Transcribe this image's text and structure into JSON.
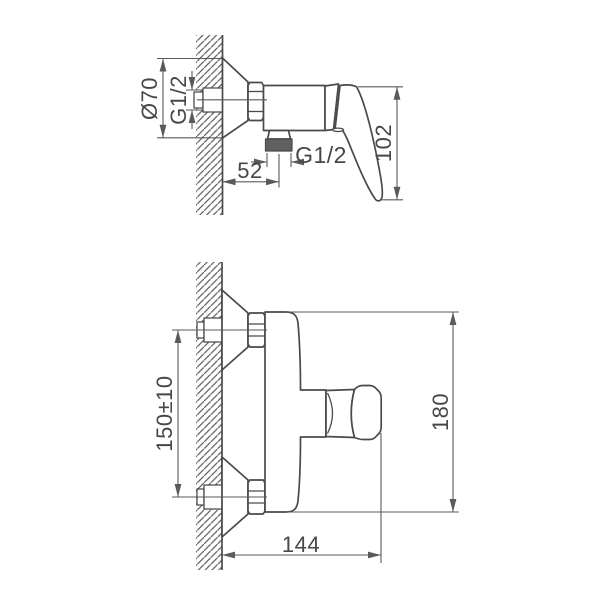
{
  "canvas": {
    "background": "#ffffff"
  },
  "drawing": {
    "line_color": "#4a4a4a",
    "dim_color": "#5a5a5a",
    "text_color": "#474747",
    "thread_fill": "#606060",
    "hatch_color": "#5a5a5a",
    "side_view": {
      "escutcheon_diameter": "Ø70",
      "wall_thread": "G1/2",
      "outlet_thread": "G1/2",
      "handle_height": "102",
      "outlet_offset": "52"
    },
    "front_view": {
      "inlet_spacing": "150±10",
      "overall_height": "180",
      "overall_width": "144"
    }
  }
}
